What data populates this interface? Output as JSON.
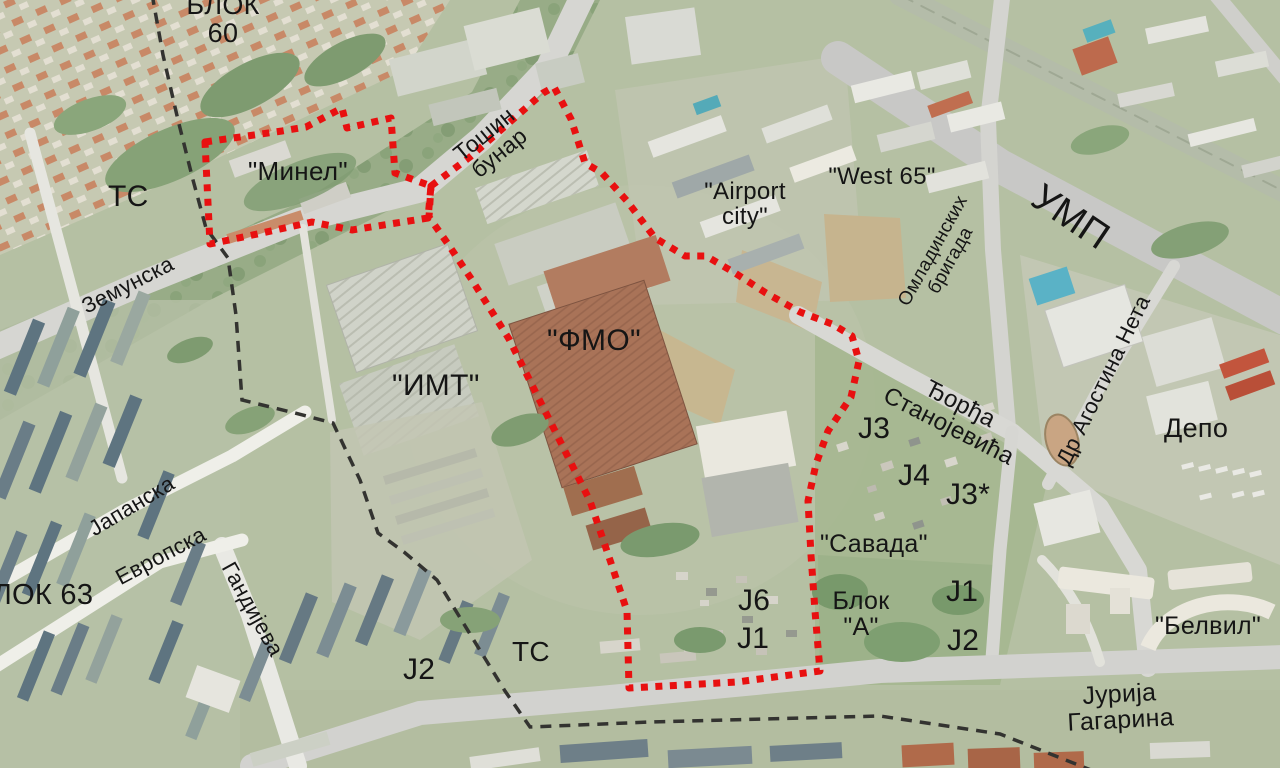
{
  "map": {
    "description": "Aerial orthophoto map of a New Belgrade district with planning annotations",
    "labels": [
      {
        "id": "blok-60",
        "text": "БЛОК 60"
      },
      {
        "id": "ts-upper",
        "text": "ТС"
      },
      {
        "id": "minel",
        "text": "\"Минел\""
      },
      {
        "id": "tosin-bunar",
        "text": "Тошин бунар"
      },
      {
        "id": "zemunska",
        "text": "Земунска"
      },
      {
        "id": "airport-city",
        "text": "\"Airport\ncity\""
      },
      {
        "id": "west-65",
        "text": "\"West 65\""
      },
      {
        "id": "ump",
        "text": "УМП"
      },
      {
        "id": "omladinskih-brigada",
        "text": "Омладинских бригада"
      },
      {
        "id": "djordja-stanojevica",
        "text": "Ђорђа Станојевића"
      },
      {
        "id": "dr-agostina-neta",
        "text": "Др Агостина Нета"
      },
      {
        "id": "depo",
        "text": "Депо"
      },
      {
        "id": "j3",
        "text": "J3"
      },
      {
        "id": "j4",
        "text": "J4"
      },
      {
        "id": "j3-star",
        "text": "J3*"
      },
      {
        "id": "savada",
        "text": "\"Савада\""
      },
      {
        "id": "blok-a",
        "text": "Блок\n\"А\""
      },
      {
        "id": "j1-east",
        "text": "J1"
      },
      {
        "id": "j2-east",
        "text": "J2"
      },
      {
        "id": "j6",
        "text": "J6"
      },
      {
        "id": "j1-mid",
        "text": "J1"
      },
      {
        "id": "j2-west",
        "text": "J2"
      },
      {
        "id": "ts-lower",
        "text": "ТС"
      },
      {
        "id": "belvil",
        "text": "\"Белвил\""
      },
      {
        "id": "jurija-gagarina",
        "text": "Јурија Гагарина"
      },
      {
        "id": "blok-63",
        "text": "ЛОК 63"
      },
      {
        "id": "japanska",
        "text": "Јапанска"
      },
      {
        "id": "evropska",
        "text": "Европска"
      },
      {
        "id": "gandijeva",
        "text": "Гандијева"
      },
      {
        "id": "fmo",
        "text": "\"ФМО\""
      },
      {
        "id": "imt",
        "text": "\"ИМТ\""
      }
    ],
    "boundaries": {
      "planning_area_outline": {
        "style": "red dotted",
        "color": "#e81010"
      },
      "cadastral_boundary": {
        "style": "black dashed",
        "color": "#333330"
      }
    },
    "colors": {
      "vegetation_base": "#b5c0a3",
      "road": "#d6d6d2",
      "minor_street": "#efefe9",
      "factory_roof_rust": "#a97358",
      "factory_roof_gray": "#d0d3c9",
      "label_text": "#151515"
    }
  }
}
